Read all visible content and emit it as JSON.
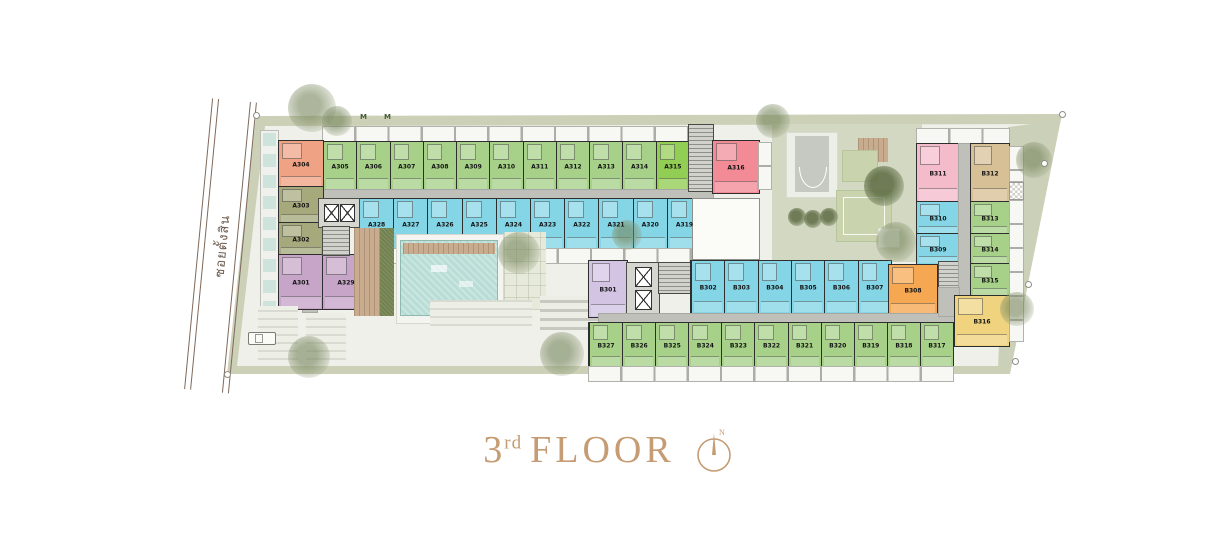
{
  "title": {
    "number": "3",
    "ordinal": "rd",
    "word": "FLOOR",
    "compass_label": "N"
  },
  "street": {
    "name": "ซอยตั้งสิน"
  },
  "colors": {
    "green": "#a7d189",
    "lime": "#92ce54",
    "blue": "#84d6e7",
    "pink": "#f28b96",
    "rose": "#f4bccb",
    "salmon": "#f0a284",
    "olive": "#a6a97c",
    "mauve": "#c6a5c8",
    "lavender": "#d3c4e4",
    "tan": "#d8c096",
    "orange": "#f5a751",
    "yellow": "#f0d37e",
    "title_accent": "#c59c73"
  },
  "wing_a": {
    "top_row": [
      {
        "label": "A305",
        "type": "green"
      },
      {
        "label": "A306",
        "type": "green"
      },
      {
        "label": "A307",
        "type": "green"
      },
      {
        "label": "A308",
        "type": "green"
      },
      {
        "label": "A309",
        "type": "green"
      },
      {
        "label": "A310",
        "type": "green"
      },
      {
        "label": "A311",
        "type": "green"
      },
      {
        "label": "A312",
        "type": "green"
      },
      {
        "label": "A313",
        "type": "green"
      },
      {
        "label": "A314",
        "type": "green"
      },
      {
        "label": "A315",
        "type": "lime"
      }
    ],
    "corner_unit": {
      "label": "A316",
      "type": "pink"
    },
    "middle_row": [
      {
        "label": "A328",
        "type": "blue"
      },
      {
        "label": "A327",
        "type": "blue"
      },
      {
        "label": "A326",
        "type": "blue"
      },
      {
        "label": "A325",
        "type": "blue"
      },
      {
        "label": "A324",
        "type": "blue"
      },
      {
        "label": "A323",
        "type": "blue"
      },
      {
        "label": "A322",
        "type": "blue"
      },
      {
        "label": "A321",
        "type": "blue"
      },
      {
        "label": "A320",
        "type": "blue"
      },
      {
        "label": "A319",
        "type": "blue"
      }
    ],
    "left_column": [
      {
        "label": "A304",
        "type": "salmon"
      },
      {
        "label": "A303",
        "type": "olive"
      },
      {
        "label": "A302",
        "type": "olive"
      }
    ],
    "bottom_pair": [
      {
        "label": "A301",
        "type": "mauve"
      },
      {
        "label": "A329",
        "type": "mauve"
      }
    ]
  },
  "wing_b": {
    "west_unit": {
      "label": "B301",
      "type": "lavender"
    },
    "upper_row": [
      {
        "label": "B302",
        "type": "blue"
      },
      {
        "label": "B303",
        "type": "blue"
      },
      {
        "label": "B304",
        "type": "blue"
      },
      {
        "label": "B305",
        "type": "blue"
      },
      {
        "label": "B306",
        "type": "blue"
      },
      {
        "label": "B307",
        "type": "blue"
      }
    ],
    "east_upper": {
      "label": "B308",
      "type": "orange"
    },
    "lower_row": [
      {
        "label": "B327",
        "type": "green"
      },
      {
        "label": "B326",
        "type": "green"
      },
      {
        "label": "B325",
        "type": "green"
      },
      {
        "label": "B324",
        "type": "green"
      },
      {
        "label": "B323",
        "type": "green"
      },
      {
        "label": "B322",
        "type": "green"
      },
      {
        "label": "B321",
        "type": "green"
      },
      {
        "label": "B320",
        "type": "green"
      },
      {
        "label": "B319",
        "type": "green"
      },
      {
        "label": "B318",
        "type": "green"
      },
      {
        "label": "B317",
        "type": "green"
      }
    ],
    "right_block": {
      "col_west": [
        {
          "label": "B311",
          "type": "rose"
        },
        {
          "label": "B310",
          "type": "blue"
        },
        {
          "label": "B309",
          "type": "blue"
        }
      ],
      "col_east": [
        {
          "label": "B312",
          "type": "tan"
        },
        {
          "label": "B313",
          "type": "green"
        },
        {
          "label": "B314",
          "type": "green"
        },
        {
          "label": "B315",
          "type": "green"
        }
      ],
      "south_unit": {
        "label": "B316",
        "type": "yellow"
      }
    }
  }
}
